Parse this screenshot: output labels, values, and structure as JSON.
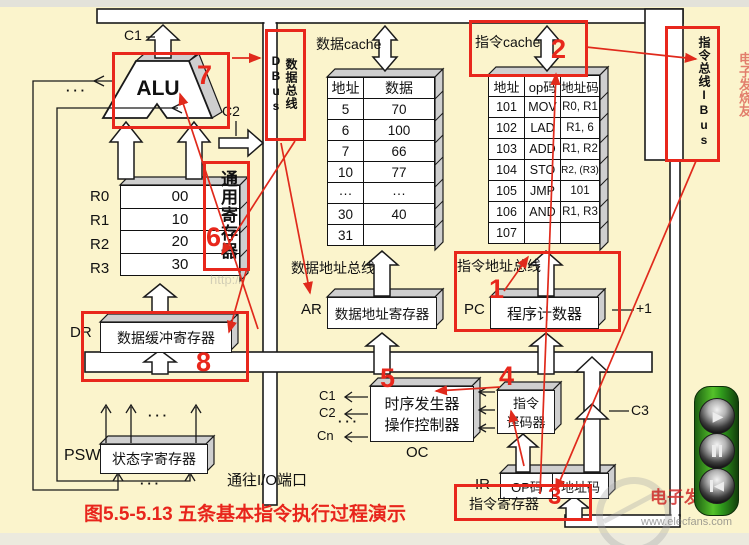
{
  "caption": "图5.5-5.13 五条基本指令执行过程演示",
  "colors": {
    "background": "#FBF4CC",
    "annotation_red": "#E8271C",
    "line_black": "#1A1A1A"
  },
  "alu": {
    "label": "ALU",
    "c1": "C1",
    "c2": "C2"
  },
  "buses": {
    "data_bus_vertical": "数据总线DBus",
    "instr_bus_vertical": "指令总线IBus",
    "data_cache": "数据cache",
    "instr_cache": "指令cache",
    "data_addr_bus": "数据地址总线",
    "instr_addr_bus": "指令地址总线",
    "io_port": "通往I/O端口"
  },
  "registers": {
    "general_label": "通用寄存器",
    "rows": [
      {
        "name": "R0",
        "value": "00"
      },
      {
        "name": "R1",
        "value": "10"
      },
      {
        "name": "R2",
        "value": "20"
      },
      {
        "name": "R3",
        "value": "30"
      }
    ]
  },
  "dr": {
    "label": "DR",
    "box": "数据缓冲寄存器"
  },
  "ar": {
    "label": "AR",
    "box": "数据地址寄存器"
  },
  "pc": {
    "label": "PC",
    "box": "程序计数器",
    "plus1": "+1"
  },
  "psw": {
    "label": "PSW",
    "box": "状态字寄存器"
  },
  "ir": {
    "label": "IR",
    "op": "OP码",
    "addr": "地址码",
    "sub": "指令寄存器"
  },
  "controller": {
    "line1": "时序发生器",
    "line2": "操作控制器",
    "oc": "OC",
    "c1": "C1",
    "c2": "C2",
    "cn": "Cn"
  },
  "decoder": {
    "line1": "指令",
    "line2": "译码器"
  },
  "c3": "C3",
  "tables": {
    "data_cache": {
      "headers": [
        "地址",
        "数据"
      ],
      "rows": [
        [
          "5",
          "70"
        ],
        [
          "6",
          "100"
        ],
        [
          "7",
          "66"
        ],
        [
          "10",
          "77"
        ],
        [
          "···",
          "···"
        ],
        [
          "30",
          "40"
        ],
        [
          "31",
          ""
        ]
      ]
    },
    "instr_cache": {
      "headers": [
        "地址",
        "op码",
        "地址码"
      ],
      "rows": [
        [
          "101",
          "MOV",
          "R0, R1"
        ],
        [
          "102",
          "LAD",
          "R1, 6"
        ],
        [
          "103",
          "ADD",
          "R1, R2"
        ],
        [
          "104",
          "STO",
          "R2, (R3)"
        ],
        [
          "105",
          "JMP",
          "101"
        ],
        [
          "106",
          "AND",
          "R1, R3"
        ],
        [
          "107",
          "",
          ""
        ]
      ]
    }
  },
  "annotations": {
    "n1": "1",
    "n2": "2",
    "n3": "3",
    "n4": "4",
    "n5": "5",
    "n6": "6",
    "n7": "7",
    "n8": "8"
  },
  "misc": {
    "dots": "···"
  },
  "watermarks": {
    "center": "http://",
    "site_red": "电子发烧友",
    "site_gray": "www.elecfans.com"
  },
  "player": {
    "play_icon": "▶",
    "prev_icon": "◀"
  }
}
